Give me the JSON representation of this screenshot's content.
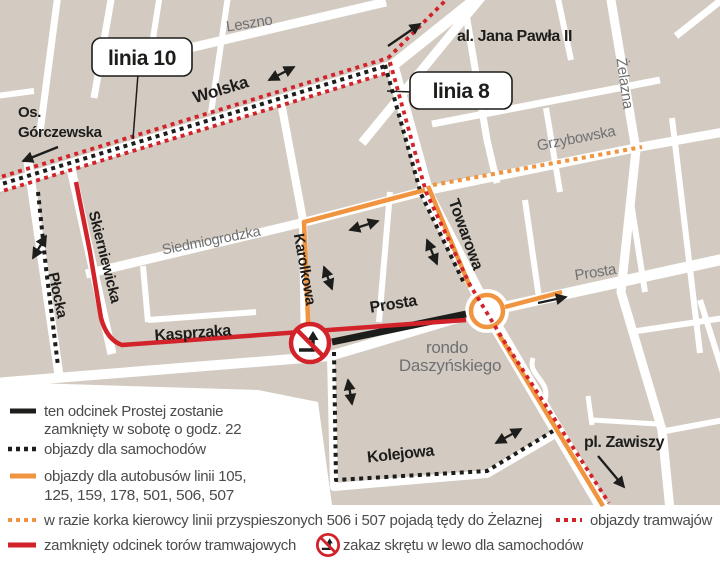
{
  "colors": {
    "map_background": "#d3cbc2",
    "street": "#ffffff",
    "tram_red": "#d2232a",
    "bus_orange": "#f0943f",
    "line_black": "#1d1d1b",
    "gray_label": "#6f7072",
    "legend_text": "#4b4b4d"
  },
  "map": {
    "callouts": {
      "linia10": "linia 10",
      "linia8": "linia 8"
    },
    "street_labels": {
      "leszno": "Leszno",
      "wolska": "Wolska",
      "os_gorczewska_line1": "Os.",
      "os_gorczewska_line2": "Górczewska",
      "al_jana_pawla": "al. Jana Pawła II",
      "zelazna": "Żelazna",
      "grzybowska": "Grzybowska",
      "towarowa": "Towarowa",
      "plocka": "Płocka",
      "skierniewicka": "Skierniewicka",
      "siedmiogrodzka": "Siedmiogrodzka",
      "karolkowa": "Karolkowa",
      "kasprzaka": "Kasprzaka",
      "prosta_west": "Prosta",
      "prosta_east": "Prosta",
      "kolejowa": "Kolejowa",
      "pl_zawiszy": "pl. Zawiszy",
      "rondo_line1": "rondo",
      "rondo_line2": "Daszyńskiego"
    }
  },
  "legend": {
    "closed_prosta_line1": "ten odcinek Prostej zostanie",
    "closed_prosta_line2": "zamknięty w sobotę o godz. 22",
    "car_detours": "objazdy dla samochodów",
    "bus_detours_line1": "objazdy dla autobusów linii 105,",
    "bus_detours_line2": "125, 159, 178, 501, 506, 507",
    "express_fallback": "w razie korka kierowcy linii przyspieszonych 506 i 507 pojadą tędy do Żelaznej",
    "tram_detours": "objazdy tramwajów",
    "closed_tram_tracks": "zamknięty odcinek torów tramwajowych",
    "no_left_turn": "zakaz skrętu w lewo dla samochodów"
  }
}
